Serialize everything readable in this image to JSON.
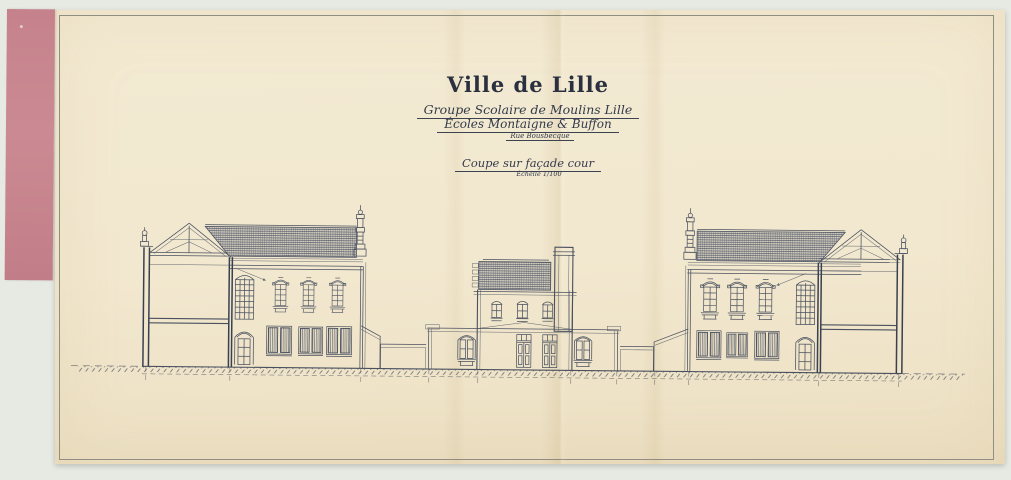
{
  "document": {
    "city_title": "Ville de Lille",
    "project_line1": "Groupe Scolaire de Moulins Lille",
    "project_line2": "Écoles Montaigne & Buffon",
    "street_line": "Rue Bousbecque",
    "drawing_title": "Coupe sur façade cour",
    "scale_label": "Échelle 1/100"
  },
  "colors": {
    "scanner_background": "#e6eae3",
    "paper": "#f2e8cf",
    "binding_strip": "#c9868f",
    "ink": "#49505f",
    "frame_line": "#8e8e83"
  }
}
